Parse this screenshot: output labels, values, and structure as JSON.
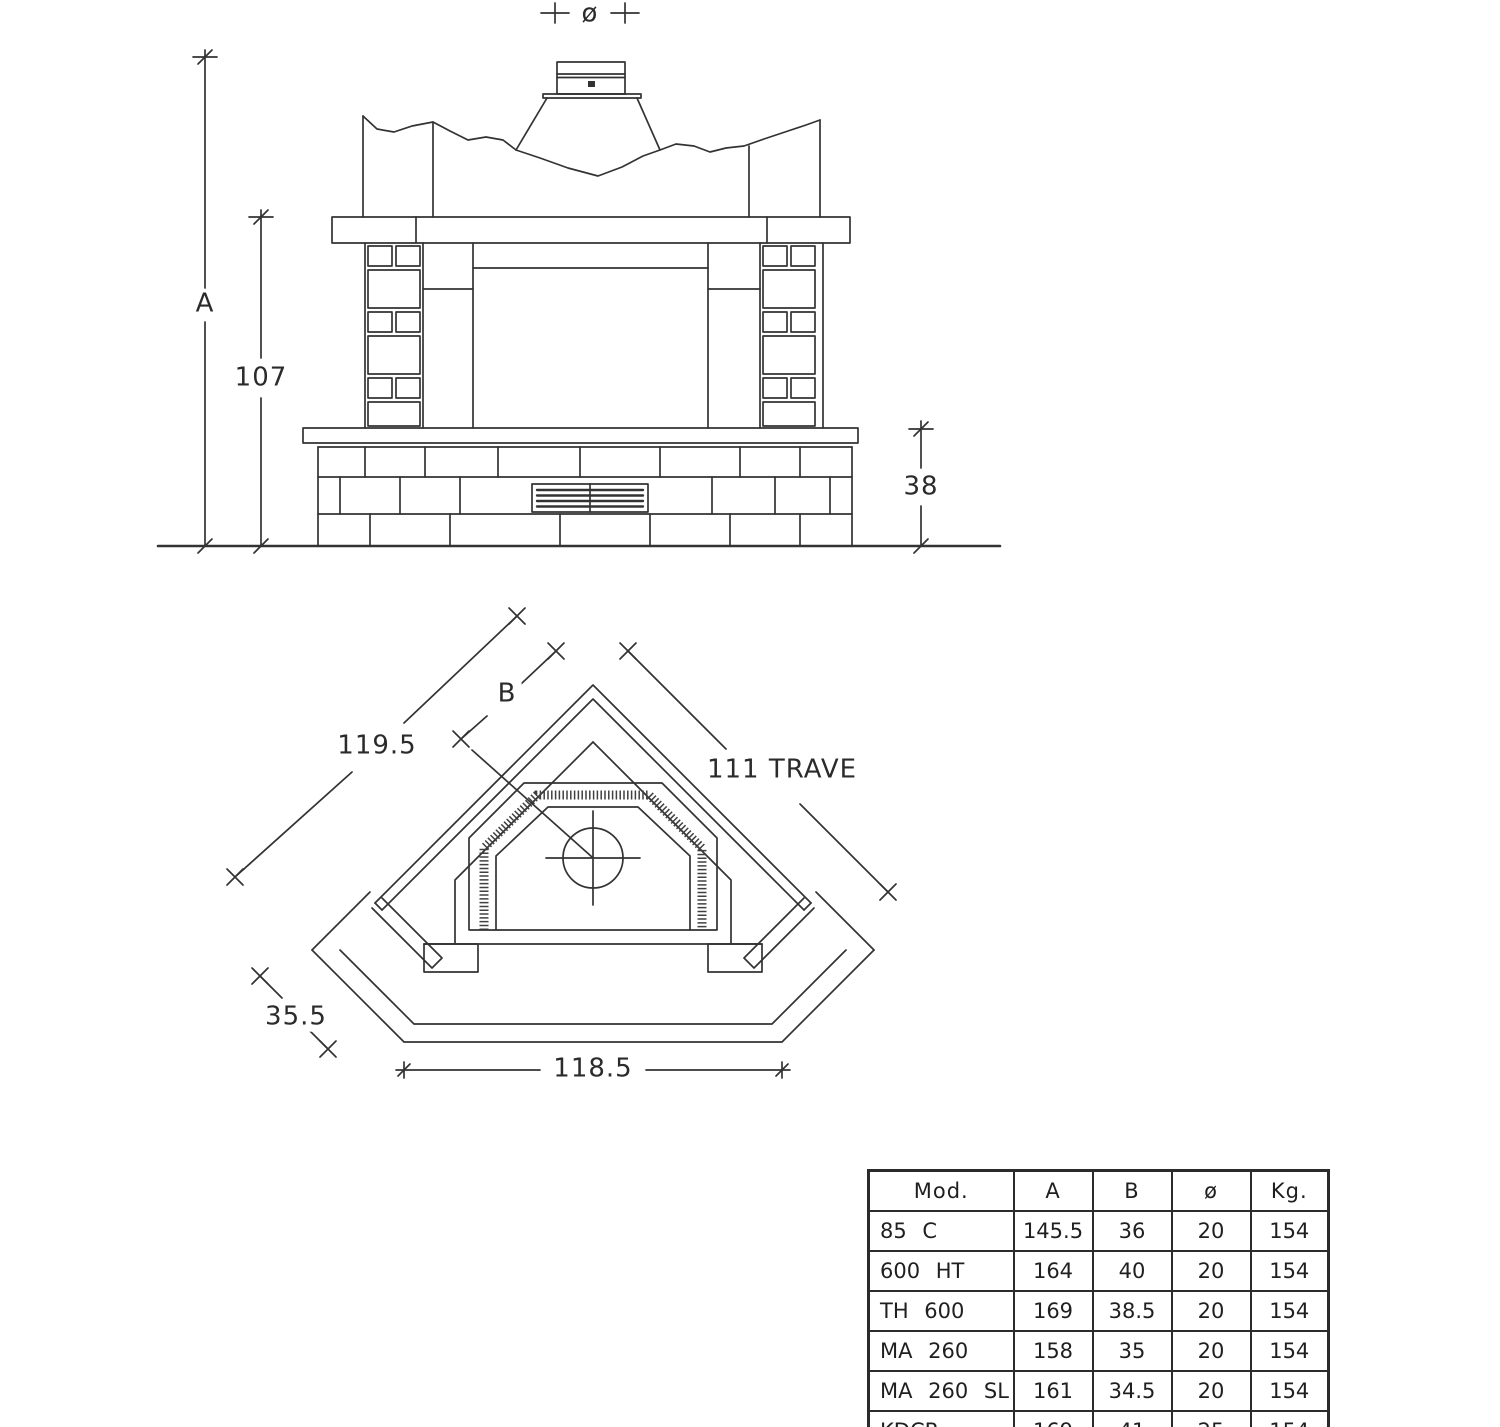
{
  "front_view": {
    "dim_flue_diameter": "ø",
    "dim_total_height": "A",
    "dim_mantel_height": "107",
    "dim_base_height": "38"
  },
  "plan_view": {
    "dim_side_length": "119.5",
    "dim_flue_offset": "B",
    "dim_beam_length": "111 TRAVE",
    "dim_chamfer": "35.5",
    "dim_front_width": "118.5"
  },
  "table": {
    "headers": [
      "Mod.",
      "A",
      "B",
      "ø",
      "Kg."
    ],
    "rows": [
      {
        "mod": "85 C",
        "a": "145.5",
        "b": "36",
        "d": "20",
        "kg": "154"
      },
      {
        "mod": "600 HT",
        "a": "164",
        "b": "40",
        "d": "20",
        "kg": "154"
      },
      {
        "mod": "TH 600",
        "a": "169",
        "b": "38.5",
        "d": "20",
        "kg": "154"
      },
      {
        "mod": "MA 260",
        "a": "158",
        "b": "35",
        "d": "20",
        "kg": "154"
      },
      {
        "mod": "MA 260 SL",
        "a": "161",
        "b": "34.5",
        "d": "20",
        "kg": "154"
      },
      {
        "mod": "KDCR",
        "a": "169",
        "b": "41",
        "d": "25",
        "kg": "154"
      }
    ]
  },
  "colors": {
    "line": "#333333",
    "background": "#ffffff"
  }
}
